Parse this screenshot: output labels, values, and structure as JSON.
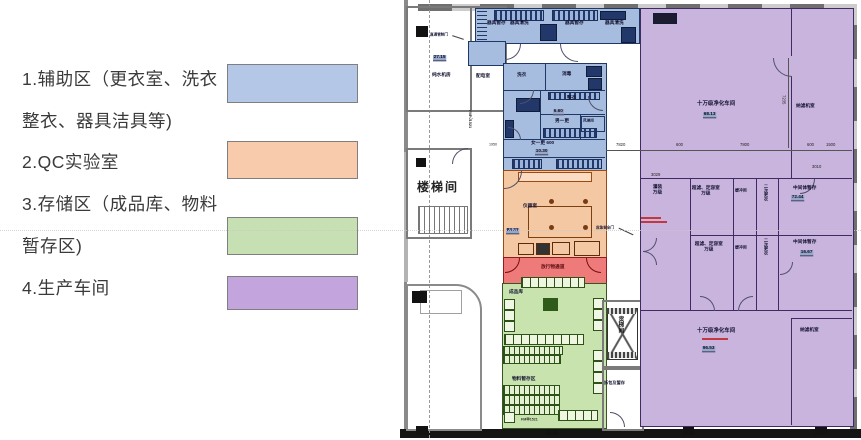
{
  "legend": {
    "items": [
      {
        "line1": "1.辅助区（更衣室、洗衣",
        "line2": "整衣、器具洁具等)",
        "color": "#b4c7e7"
      },
      {
        "line1": "2.QC实验室",
        "line2": "",
        "color": "#f8cbad"
      },
      {
        "line1": "3.存储区（成品库、物料",
        "line2": "暂存区)",
        "color": "#c6e0b4"
      },
      {
        "line1": "4.生产车间",
        "line2": "",
        "color": "#c3a4dd"
      }
    ]
  },
  "plan": {
    "colors": {
      "aux": "#a7bde0",
      "qc": "#f3c8a2",
      "storage": "#c8e3ad",
      "production": "#c9b4de",
      "corridor": "#ee7a7a"
    },
    "labels": [
      "器具暂存",
      "器具清洗",
      "器具暂存",
      "器具清洗",
      "洗衣",
      "消毒",
      "整衣",
      "男一更",
      "女一更 600",
      "风淋间",
      "配电室",
      "纯水机房",
      "直通管制门",
      "FM乙1521",
      "楼梯间",
      "仪器室",
      "放行物通道",
      "成品库",
      "物料暂存区",
      "货梯间",
      "拆包及暂存",
      "FM甲1521",
      "十万级净化车间",
      "纳滤机室",
      "灌装万级",
      "超滤、定容室万级",
      "缓冲间",
      "二次更衣",
      "中间体暂存",
      "超滤、定容室万级",
      "缓冲间",
      "二次更衣",
      "中间体暂存",
      "十万级净化车间",
      "纳滤机室",
      "应急安全门"
    ],
    "numbers": [
      "27.15",
      "6.60",
      "10.30",
      "83.22",
      "68.13",
      "72.44",
      "16.67",
      "96.53"
    ],
    "dimensions": [
      "7820",
      "600",
      "7800",
      "600",
      "1500",
      "3029",
      "3010",
      "7235",
      "1950"
    ]
  }
}
